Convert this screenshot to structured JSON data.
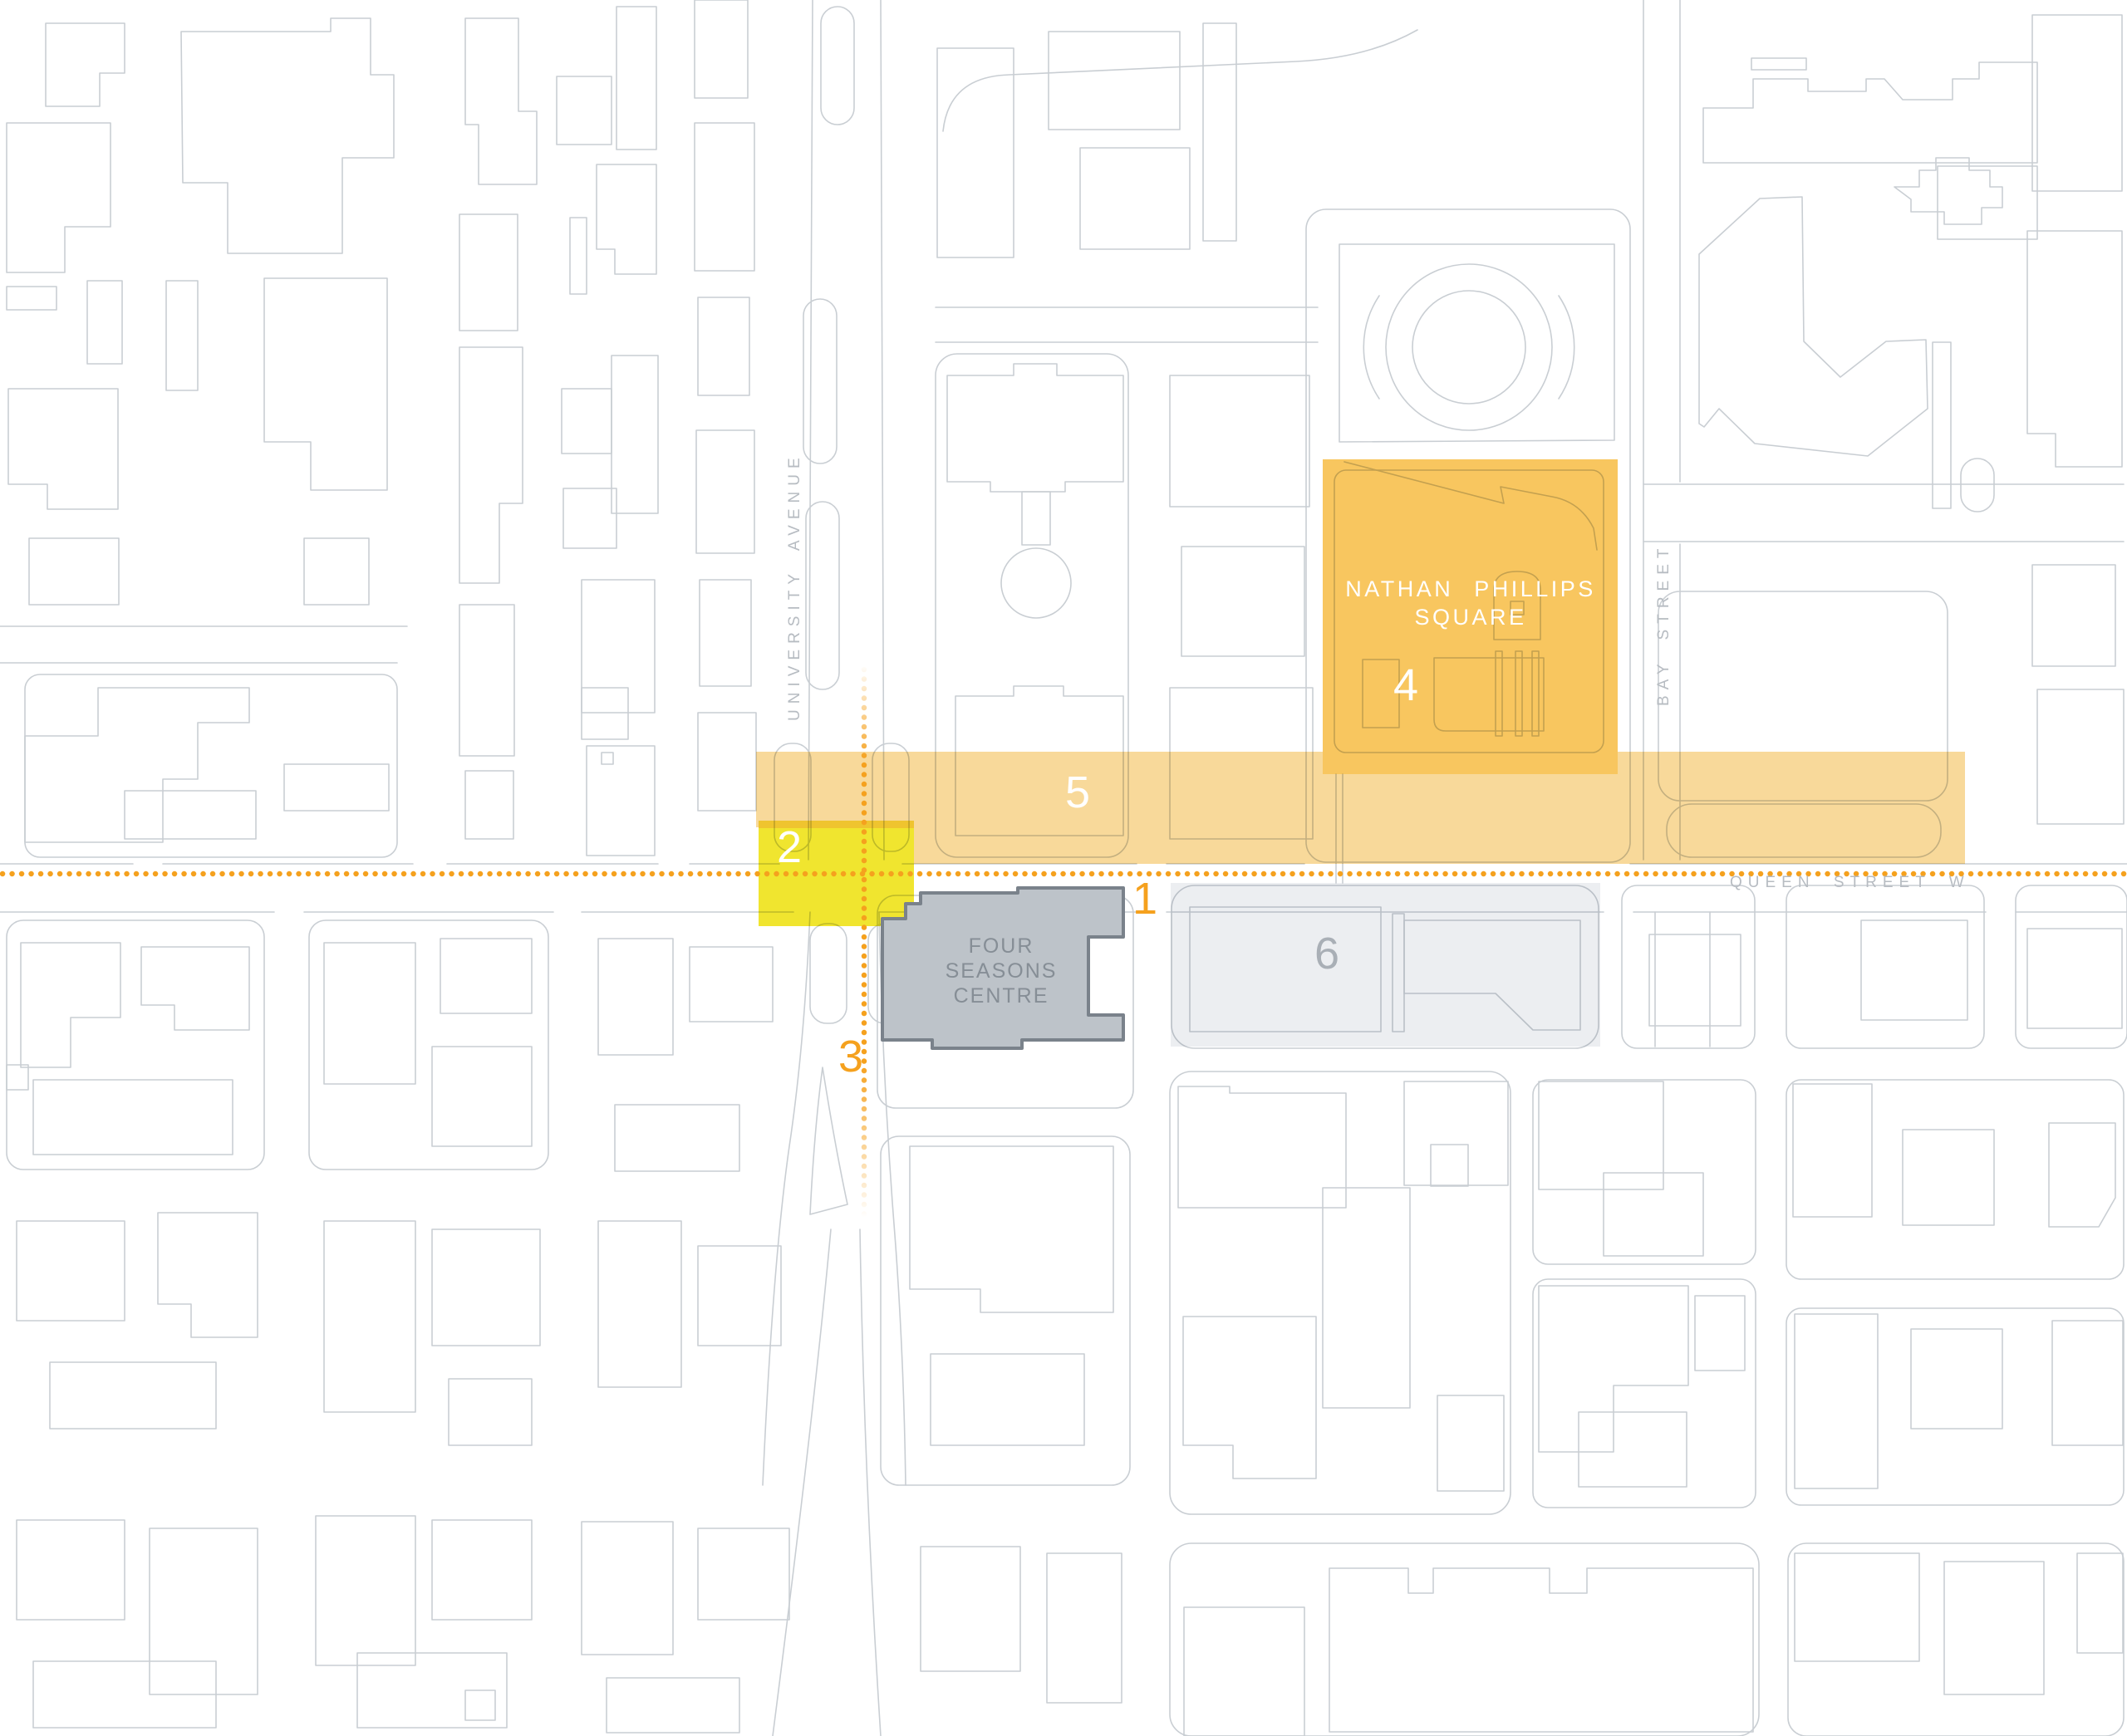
{
  "map": {
    "streets": {
      "university_avenue": "UNIVERSITY AVENUE",
      "bay_street": "BAY STREET",
      "queen_street_w": "QUEEN STREET W"
    },
    "places": {
      "nathan_phillips_square": {
        "line1": "NATHAN PHILLIPS",
        "line2": "SQUARE"
      },
      "four_seasons_centre": {
        "line1": "FOUR",
        "line2": "SEASONS",
        "line3": "CENTRE"
      }
    },
    "zone_markers": {
      "1": "1",
      "2": "2",
      "3": "3",
      "4": "4",
      "5": "5",
      "6": "6"
    },
    "colors": {
      "queen_axis_dots": "#F5A11E",
      "university_axis_dots": "#F5A11E",
      "zone4_nathan_phillips_fill": "#F8C65F",
      "zone5_queen_band_fill": "#F8D99A",
      "zone2_intersection_fill": "#F0E52F",
      "zone2_top_edge_fill": "#EFC42F",
      "zone6_fill": "#ECEEF1",
      "four_seasons_fill": "#BDC3C9",
      "four_seasons_border": "#7A828B",
      "outline_gray": "#C9CED3",
      "street_label_gray": "#B7BCC2"
    }
  }
}
